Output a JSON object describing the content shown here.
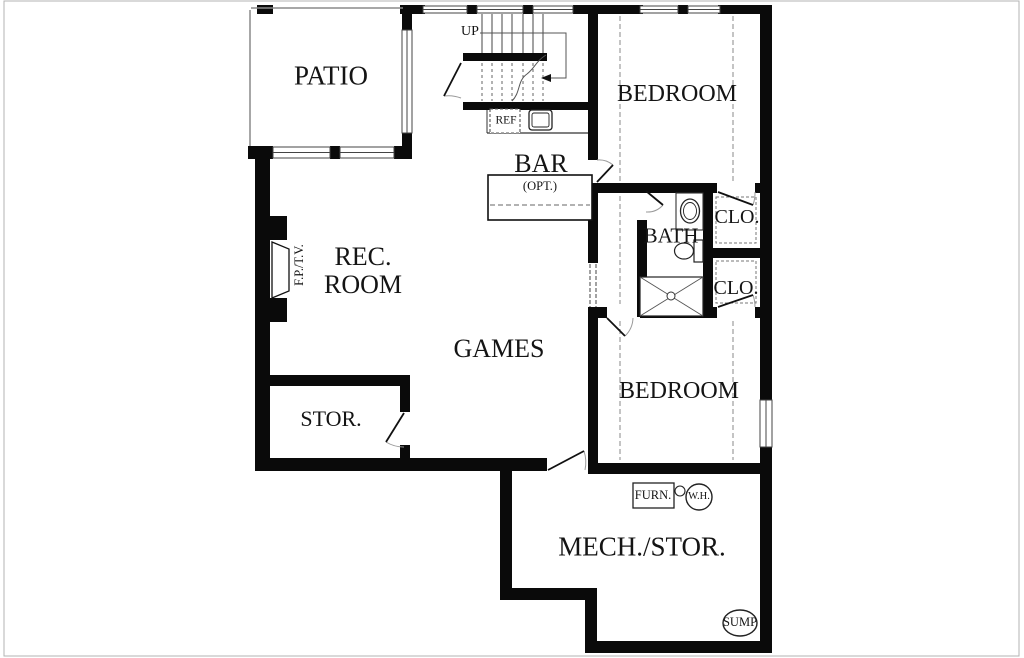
{
  "meta": {
    "width": 1024,
    "height": 658,
    "background": "#ffffff",
    "wall_color": "#0a0a0a",
    "thin_line_color": "#8a8a8a",
    "frame_color": "#b3b3b3",
    "text_color": "#141414"
  },
  "labels": [
    {
      "id": "patio",
      "text": "PATIO",
      "x": 331,
      "y": 76,
      "size": 27
    },
    {
      "id": "up",
      "text": "UP",
      "x": 470,
      "y": 32,
      "size": 14
    },
    {
      "id": "ref",
      "text": "REF",
      "x": 506,
      "y": 121,
      "size": 11.5
    },
    {
      "id": "bar",
      "text": "BAR",
      "x": 541,
      "y": 164,
      "size": 26
    },
    {
      "id": "bar-opt",
      "text": "(OPT.)",
      "x": 540,
      "y": 186,
      "size": 12.5
    },
    {
      "id": "bedroom-1",
      "text": "BEDROOM",
      "x": 677,
      "y": 94,
      "size": 24
    },
    {
      "id": "bath",
      "text": "BATH",
      "x": 671,
      "y": 236,
      "size": 21
    },
    {
      "id": "closet-1",
      "text": "CLO.",
      "x": 737,
      "y": 217,
      "size": 20
    },
    {
      "id": "closet-2",
      "text": "CLO.",
      "x": 736,
      "y": 288,
      "size": 20
    },
    {
      "id": "rec-line1",
      "text": "REC.",
      "x": 363,
      "y": 257,
      "size": 26
    },
    {
      "id": "rec-line2",
      "text": "ROOM",
      "x": 363,
      "y": 285,
      "size": 26
    },
    {
      "id": "fp-tv",
      "text": "F.P./T.V.",
      "x": 299,
      "y": 265,
      "size": 12.5,
      "rot": true
    },
    {
      "id": "games",
      "text": "GAMES",
      "x": 499,
      "y": 349,
      "size": 26
    },
    {
      "id": "storage",
      "text": "STOR.",
      "x": 331,
      "y": 419,
      "size": 22
    },
    {
      "id": "furnace",
      "text": "FURN.",
      "x": 653,
      "y": 495,
      "size": 12.5
    },
    {
      "id": "water-heater",
      "text": "W.H.",
      "x": 699,
      "y": 497,
      "size": 10.5
    },
    {
      "id": "bedroom-2",
      "text": "BEDROOM",
      "x": 679,
      "y": 391,
      "size": 24
    },
    {
      "id": "mech-stor",
      "text": "MECH./STOR.",
      "x": 642,
      "y": 547,
      "size": 27
    },
    {
      "id": "sump",
      "text": "SUMP",
      "x": 740,
      "y": 622,
      "size": 12.5
    }
  ],
  "walls": [
    [
      400,
      5,
      25,
      9
    ],
    [
      467,
      5,
      10,
      9
    ],
    [
      523,
      5,
      10,
      9
    ],
    [
      573,
      5,
      30,
      9
    ],
    [
      597,
      5,
      46,
      9
    ],
    [
      678,
      5,
      10,
      9
    ],
    [
      718,
      5,
      54,
      9
    ],
    [
      760,
      5,
      12,
      395
    ],
    [
      760,
      447,
      12,
      206
    ],
    [
      588,
      14,
      10,
      146
    ],
    [
      588,
      183,
      10,
      80
    ],
    [
      588,
      310,
      10,
      164
    ],
    [
      588,
      183,
      129,
      10
    ],
    [
      755,
      183,
      10,
      10
    ],
    [
      637,
      183,
      10,
      8
    ],
    [
      637,
      220,
      10,
      97
    ],
    [
      703,
      183,
      10,
      134
    ],
    [
      703,
      248,
      62,
      10
    ],
    [
      588,
      307,
      19,
      11
    ],
    [
      640,
      307,
      77,
      11
    ],
    [
      755,
      307,
      10,
      11
    ],
    [
      588,
      463,
      184,
      11
    ],
    [
      585,
      641,
      187,
      12
    ],
    [
      585,
      588,
      12,
      65
    ],
    [
      500,
      588,
      97,
      12
    ],
    [
      500,
      458,
      12,
      142
    ],
    [
      255,
      458,
      292,
      13
    ],
    [
      255,
      148,
      15,
      323
    ],
    [
      270,
      216,
      17,
      24
    ],
    [
      270,
      298,
      17,
      24
    ],
    [
      257,
      5,
      16,
      9
    ],
    [
      402,
      5,
      10,
      27
    ],
    [
      402,
      133,
      10,
      26
    ],
    [
      248,
      146,
      25,
      13
    ],
    [
      330,
      146,
      10,
      13
    ],
    [
      394,
      146,
      18,
      13
    ],
    [
      463,
      53,
      84,
      8
    ],
    [
      463,
      102,
      135,
      8
    ],
    [
      258,
      375,
      152,
      11
    ],
    [
      400,
      386,
      10,
      26
    ],
    [
      400,
      445,
      10,
      13
    ]
  ],
  "windows": [
    [
      423,
      6,
      44,
      7,
      "h"
    ],
    [
      477,
      6,
      46,
      7,
      "h"
    ],
    [
      533,
      6,
      40,
      7,
      "h"
    ],
    [
      640,
      6,
      38,
      7,
      "h"
    ],
    [
      688,
      6,
      32,
      7,
      "h"
    ],
    [
      760,
      400,
      12,
      47,
      "v"
    ],
    [
      402,
      30,
      10,
      103,
      "v"
    ],
    [
      273,
      147,
      57,
      11,
      "h"
    ],
    [
      340,
      147,
      54,
      11,
      "h"
    ]
  ],
  "extras": [
    {
      "t": "rect",
      "n": "image-border",
      "x": 4,
      "y": 1,
      "w": 1015,
      "h": 655,
      "c": "#b3b3b3",
      "s": 1
    },
    {
      "t": "line",
      "n": "patio-edge",
      "x1": 250,
      "y1": 10,
      "x2": 250,
      "y2": 146,
      "c": "#8a8a8a",
      "s": 1.5
    },
    {
      "t": "line",
      "n": "patio-edge",
      "x1": 251,
      "y1": 8,
      "x2": 403,
      "y2": 8,
      "c": "#8a8a8a",
      "s": 1.5
    },
    {
      "t": "line",
      "n": "stair-tread",
      "x1": 482,
      "y1": 14,
      "x2": 482,
      "y2": 53,
      "c": "#444",
      "s": 1
    },
    {
      "t": "line",
      "n": "stair-tread",
      "x1": 492,
      "y1": 14,
      "x2": 492,
      "y2": 53,
      "c": "#444",
      "s": 1
    },
    {
      "t": "line",
      "n": "stair-tread",
      "x1": 502,
      "y1": 14,
      "x2": 502,
      "y2": 53,
      "c": "#444",
      "s": 1
    },
    {
      "t": "line",
      "n": "stair-tread",
      "x1": 512,
      "y1": 14,
      "x2": 512,
      "y2": 53,
      "c": "#444",
      "s": 1
    },
    {
      "t": "line",
      "n": "stair-tread",
      "x1": 523,
      "y1": 14,
      "x2": 523,
      "y2": 53,
      "c": "#444",
      "s": 1
    },
    {
      "t": "line",
      "n": "stair-tread",
      "x1": 533,
      "y1": 14,
      "x2": 533,
      "y2": 53,
      "c": "#444",
      "s": 1
    },
    {
      "t": "line",
      "n": "stair-tread",
      "x1": 543,
      "y1": 14,
      "x2": 543,
      "y2": 53,
      "c": "#444",
      "s": 1
    },
    {
      "t": "line",
      "n": "stair-tread-dashed",
      "x1": 482,
      "y1": 63,
      "x2": 482,
      "y2": 101,
      "c": "#666",
      "s": 1,
      "dash": "3 3"
    },
    {
      "t": "line",
      "n": "stair-tread-dashed",
      "x1": 492,
      "y1": 63,
      "x2": 492,
      "y2": 101,
      "c": "#666",
      "s": 1,
      "dash": "3 3"
    },
    {
      "t": "line",
      "n": "stair-tread-dashed",
      "x1": 502,
      "y1": 63,
      "x2": 502,
      "y2": 101,
      "c": "#666",
      "s": 1,
      "dash": "3 3"
    },
    {
      "t": "line",
      "n": "stair-tread-dashed",
      "x1": 512,
      "y1": 63,
      "x2": 512,
      "y2": 101,
      "c": "#666",
      "s": 1,
      "dash": "3 3"
    },
    {
      "t": "line",
      "n": "stair-tread-dashed",
      "x1": 523,
      "y1": 63,
      "x2": 523,
      "y2": 101,
      "c": "#666",
      "s": 1,
      "dash": "3 3"
    },
    {
      "t": "line",
      "n": "stair-tread-dashed",
      "x1": 533,
      "y1": 63,
      "x2": 533,
      "y2": 101,
      "c": "#666",
      "s": 1,
      "dash": "3 3"
    },
    {
      "t": "line",
      "n": "stair-tread-dashed",
      "x1": 543,
      "y1": 63,
      "x2": 543,
      "y2": 101,
      "c": "#666",
      "s": 1,
      "dash": "3 3"
    },
    {
      "t": "path",
      "n": "stair-break-line",
      "d": "M 512 101 C 521 92 517 81 527 74 C 535 68 536 61 546 55",
      "c": "#555",
      "s": 1
    },
    {
      "t": "pline",
      "n": "stair-direction-line",
      "pts": "480,33 566,33 566,78 551,78",
      "c": "#555",
      "s": 1
    },
    {
      "t": "poly",
      "n": "arrowhead",
      "pts": "551,74 541,78 551,82",
      "f": "#111"
    },
    {
      "t": "line",
      "n": "counter-edge",
      "x1": 487,
      "y1": 133,
      "x2": 588,
      "y2": 133,
      "c": "#333",
      "s": 1.2
    },
    {
      "t": "line",
      "n": "counter-edge",
      "x1": 487,
      "y1": 110,
      "x2": 487,
      "y2": 133,
      "c": "#333",
      "s": 1
    },
    {
      "t": "rect",
      "n": "refrigerator-icon",
      "x": 490,
      "y": 109,
      "w": 30,
      "h": 24,
      "c": "#555",
      "s": 1.1,
      "dash": "3 2",
      "f": "#fff"
    },
    {
      "t": "rect",
      "n": "sink-icon",
      "x": 529,
      "y": 110,
      "w": 23,
      "h": 20,
      "rx": 3,
      "c": "#222",
      "s": 1.3,
      "f": "#fff"
    },
    {
      "t": "rect",
      "n": "sink-icon",
      "x": 532,
      "y": 113,
      "w": 17,
      "h": 14,
      "rx": 2,
      "c": "#222",
      "s": 0.9
    },
    {
      "t": "rect",
      "n": "bar-counter",
      "x": 488,
      "y": 175,
      "w": 104,
      "h": 45,
      "c": "#111",
      "s": 1.6,
      "f": "#fff"
    },
    {
      "t": "line",
      "n": "bar-counter-dashed",
      "x1": 490,
      "y1": 205,
      "x2": 590,
      "y2": 205,
      "c": "#666",
      "s": 1,
      "dash": "5 3"
    },
    {
      "t": "line",
      "n": "ceiling-dashed",
      "x1": 620,
      "y1": 16,
      "x2": 620,
      "y2": 181,
      "c": "#888",
      "s": 1,
      "dash": "5 3"
    },
    {
      "t": "line",
      "n": "ceiling-dashed",
      "x1": 733,
      "y1": 16,
      "x2": 733,
      "y2": 181,
      "c": "#888",
      "s": 1,
      "dash": "5 3"
    },
    {
      "t": "line",
      "n": "ceiling-dashed",
      "x1": 620,
      "y1": 196,
      "x2": 620,
      "y2": 304,
      "c": "#888",
      "s": 1,
      "dash": "5 3"
    },
    {
      "t": "line",
      "n": "ceiling-dashed",
      "x1": 620,
      "y1": 321,
      "x2": 620,
      "y2": 460,
      "c": "#888",
      "s": 1,
      "dash": "5 3"
    },
    {
      "t": "line",
      "n": "ceiling-dashed",
      "x1": 733,
      "y1": 321,
      "x2": 733,
      "y2": 460,
      "c": "#888",
      "s": 1,
      "dash": "5 3"
    },
    {
      "t": "line",
      "n": "understair-opening-dashed",
      "x1": 590,
      "y1": 264,
      "x2": 590,
      "y2": 307,
      "c": "#444",
      "s": 1,
      "dash": "4 2"
    },
    {
      "t": "line",
      "n": "understair-opening-dashed",
      "x1": 596,
      "y1": 264,
      "x2": 596,
      "y2": 307,
      "c": "#444",
      "s": 1,
      "dash": "4 2"
    },
    {
      "t": "rect",
      "n": "closet-shelf-dashed",
      "x": 716,
      "y": 197,
      "w": 40,
      "h": 46,
      "c": "#777",
      "s": 1,
      "dash": "3 2"
    },
    {
      "t": "rect",
      "n": "closet-shelf-dashed",
      "x": 716,
      "y": 261,
      "w": 40,
      "h": 42,
      "c": "#777",
      "s": 1,
      "dash": "3 2"
    },
    {
      "t": "rect",
      "n": "vanity-counter",
      "x": 676,
      "y": 193,
      "w": 27,
      "h": 37,
      "c": "#333",
      "s": 1.1,
      "f": "#fff"
    },
    {
      "t": "ellipse",
      "n": "sink-icon",
      "cx": 690,
      "cy": 211,
      "rx": 9.5,
      "ry": 12,
      "c": "#222",
      "s": 1.3,
      "f": "#fff"
    },
    {
      "t": "ellipse",
      "n": "sink-icon",
      "cx": 690,
      "cy": 211,
      "rx": 6.5,
      "ry": 8.5,
      "c": "#222",
      "s": 0.9
    },
    {
      "t": "rect",
      "n": "toilet-icon",
      "x": 694,
      "y": 240,
      "w": 9,
      "h": 22,
      "c": "#222",
      "s": 1.2,
      "f": "#fff"
    },
    {
      "t": "ellipse",
      "n": "toilet-icon",
      "cx": 684,
      "cy": 251,
      "rx": 9.5,
      "ry": 8,
      "c": "#222",
      "s": 1.2,
      "f": "#fff"
    },
    {
      "t": "rect",
      "n": "shower-icon",
      "x": 640,
      "y": 277,
      "w": 63,
      "h": 39,
      "c": "#222",
      "s": 1.2,
      "f": "#fff"
    },
    {
      "t": "line",
      "n": "shower-icon",
      "x1": 640,
      "y1": 277,
      "x2": 703,
      "y2": 316,
      "c": "#555",
      "s": 0.9
    },
    {
      "t": "line",
      "n": "shower-icon",
      "x1": 640,
      "y1": 316,
      "x2": 703,
      "y2": 277,
      "c": "#555",
      "s": 0.9
    },
    {
      "t": "ellipse",
      "n": "shower-drain",
      "cx": 671,
      "cy": 296,
      "rx": 4,
      "ry": 4,
      "c": "#333",
      "s": 1,
      "f": "#fff"
    },
    {
      "t": "poly",
      "n": "fireplace-icon",
      "pts": "272,242 289,249 289,291 272,298",
      "c": "#111",
      "s": 1.3,
      "f": "#fff"
    },
    {
      "t": "path",
      "n": "door-swing-arc",
      "d": "M 444 96 A 35 35 0 0 1 461 98",
      "c": "#999",
      "s": 1
    },
    {
      "t": "path",
      "n": "door-swing-arc",
      "d": "M 597 160 A 22 22 0 0 1 613 165",
      "c": "#999",
      "s": 1
    },
    {
      "t": "path",
      "n": "door-swing-arc",
      "d": "M 646 212 A 21 21 0 0 0 663 205",
      "c": "#999",
      "s": 1
    },
    {
      "t": "path",
      "n": "door-swing-arc",
      "d": "M 755 192 A 37 37 0 0 1 753 205",
      "c": "#999",
      "s": 1
    },
    {
      "t": "path",
      "n": "door-swing-arc",
      "d": "M 755 307 A 37 37 0 0 0 753 295",
      "c": "#999",
      "s": 1
    },
    {
      "t": "path",
      "n": "door-swing-arc",
      "d": "M 633 318 A 26 26 0 0 1 625 336",
      "c": "#999",
      "s": 1
    },
    {
      "t": "path",
      "n": "door-swing-arc",
      "d": "M 404 447 A 34 34 0 0 1 386 442",
      "c": "#999",
      "s": 1
    },
    {
      "t": "path",
      "n": "door-swing-arc",
      "d": "M 585 470 A 37 37 0 0 0 584 451",
      "c": "#999",
      "s": 1
    },
    {
      "t": "line",
      "n": "door-leaf",
      "x1": 461,
      "y1": 63,
      "x2": 444,
      "y2": 96,
      "c": "#111",
      "s": 1.8
    },
    {
      "t": "line",
      "n": "door-leaf",
      "x1": 597,
      "y1": 182,
      "x2": 613,
      "y2": 165,
      "c": "#111",
      "s": 1.8
    },
    {
      "t": "line",
      "n": "door-leaf",
      "x1": 646,
      "y1": 191,
      "x2": 663,
      "y2": 205,
      "c": "#111",
      "s": 1.8
    },
    {
      "t": "line",
      "n": "door-leaf",
      "x1": 718,
      "y1": 192,
      "x2": 753,
      "y2": 205,
      "c": "#111",
      "s": 1.8
    },
    {
      "t": "line",
      "n": "door-leaf",
      "x1": 718,
      "y1": 307,
      "x2": 753,
      "y2": 295,
      "c": "#111",
      "s": 1.8
    },
    {
      "t": "line",
      "n": "door-leaf",
      "x1": 607,
      "y1": 318,
      "x2": 625,
      "y2": 336,
      "c": "#111",
      "s": 1.8
    },
    {
      "t": "line",
      "n": "door-leaf",
      "x1": 404,
      "y1": 413,
      "x2": 386,
      "y2": 442,
      "c": "#111",
      "s": 1.8
    },
    {
      "t": "line",
      "n": "door-leaf",
      "x1": 548,
      "y1": 470,
      "x2": 584,
      "y2": 451,
      "c": "#111",
      "s": 1.8
    },
    {
      "t": "rect",
      "n": "furnace-icon",
      "x": 633,
      "y": 483,
      "w": 41,
      "h": 25,
      "c": "#222",
      "s": 1.3,
      "f": "#fff"
    },
    {
      "t": "ellipse",
      "n": "pipe-icon",
      "cx": 680,
      "cy": 491,
      "rx": 5,
      "ry": 5,
      "c": "#222",
      "s": 1.1,
      "f": "#fff"
    },
    {
      "t": "ellipse",
      "n": "water-heater-icon",
      "cx": 699,
      "cy": 497,
      "rx": 13,
      "ry": 13,
      "c": "#222",
      "s": 1.4,
      "f": "#fff"
    },
    {
      "t": "ellipse",
      "n": "sump-icon",
      "cx": 740,
      "cy": 623,
      "rx": 17,
      "ry": 13,
      "c": "#222",
      "s": 1.4,
      "f": "#fff"
    }
  ]
}
